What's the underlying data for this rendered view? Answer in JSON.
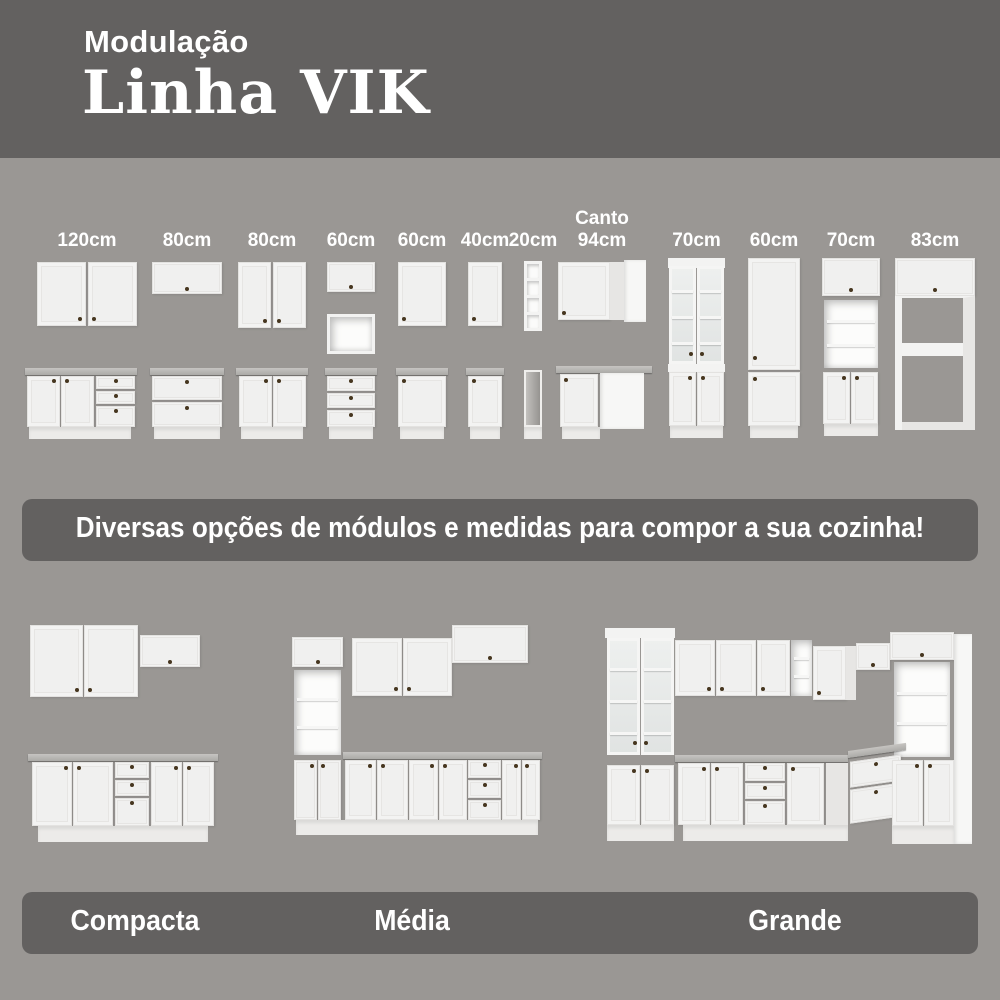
{
  "header": {
    "eyebrow": "Modulação",
    "title": "Linha VIK"
  },
  "modules": [
    {
      "label": "120cm"
    },
    {
      "label": "80cm"
    },
    {
      "label": "80cm"
    },
    {
      "label": "60cm"
    },
    {
      "label": "60cm"
    },
    {
      "label": "40cm"
    },
    {
      "label": "20cm"
    },
    {
      "label": "Canto\n94cm"
    },
    {
      "label": "70cm"
    },
    {
      "label": "60cm"
    },
    {
      "label": "70cm"
    },
    {
      "label": "83cm"
    }
  ],
  "banner": {
    "text": "Diversas opções de módulos e medidas para compor a sua cozinha!"
  },
  "kitchens": [
    {
      "name": "Compacta"
    },
    {
      "name": "Média"
    },
    {
      "name": "Grande"
    }
  ],
  "colors": {
    "background": "#9a9794",
    "band": "#636160",
    "cabinet_white": "#f3f3f2",
    "countertop_gray": "#b1afac",
    "knob_brown": "#46361f",
    "text_white": "#ffffff"
  }
}
